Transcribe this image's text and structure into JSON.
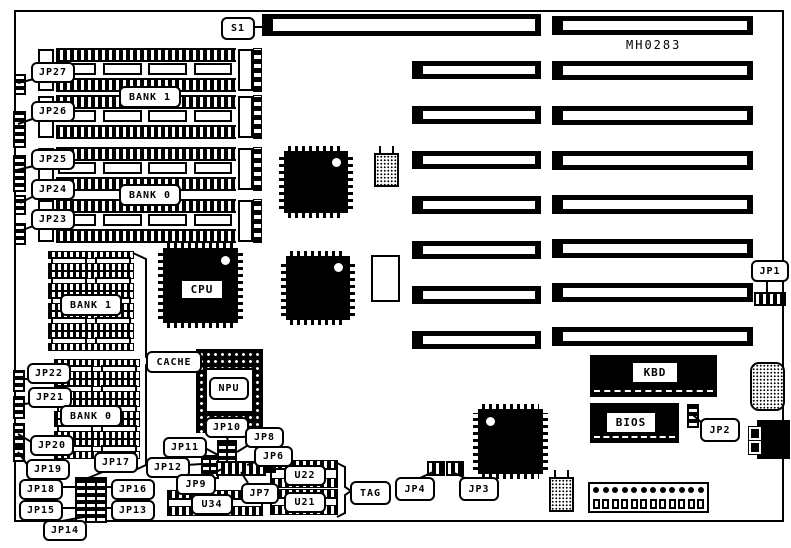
{
  "part_number": "MH0283",
  "labels": {
    "s1": "S1",
    "jp1": "JP1",
    "jp2": "JP2",
    "jp3": "JP3",
    "jp4": "JP4",
    "jp6": "JP6",
    "jp7": "JP7",
    "jp8": "JP8",
    "jp9": "JP9",
    "jp10": "JP10",
    "jp11": "JP11",
    "jp12": "JP12",
    "jp13": "JP13",
    "jp14": "JP14",
    "jp15": "JP15",
    "jp16": "JP16",
    "jp17": "JP17",
    "jp18": "JP18",
    "jp19": "JP19",
    "jp20": "JP20",
    "jp21": "JP21",
    "jp22": "JP22",
    "jp23": "JP23",
    "jp24": "JP24",
    "jp25": "JP25",
    "jp26": "JP26",
    "jp27": "JP27",
    "bank0": "BANK 0",
    "bank1": "BANK 1",
    "cpu": "CPU",
    "npu": "NPU",
    "cache": "CACHE",
    "tag": "TAG",
    "kbd": "KBD",
    "bios": "BIOS",
    "u21": "U21",
    "u22": "U22",
    "u34": "U34"
  }
}
